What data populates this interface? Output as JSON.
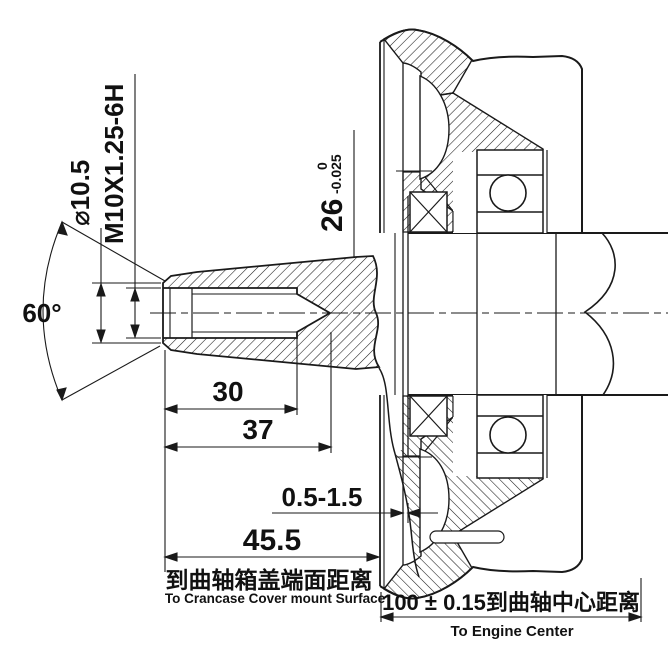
{
  "drawing": {
    "dimensions": {
      "counterbore_dia": "⌀10.5",
      "thread_spec": "M10X1.25-6H",
      "countersink_angle": "60°",
      "taper_dia": "26",
      "taper_tol_upper": "0",
      "taper_tol_lower": "-0.025",
      "thread_depth": "30",
      "bore_depth": "37",
      "gap_range": "0.5-1.5",
      "mount_face_distance": "45.5",
      "center_distance": "100 ± 0.15到曲轴中心距离"
    },
    "notes": {
      "mount_cn": "到曲轴箱盖端面距离",
      "mount_en": "To Crancase Cover mount Surface",
      "center_en": "To Engine Center"
    },
    "colors": {
      "line": "#1a1a1a",
      "background": "#ffffff"
    }
  }
}
